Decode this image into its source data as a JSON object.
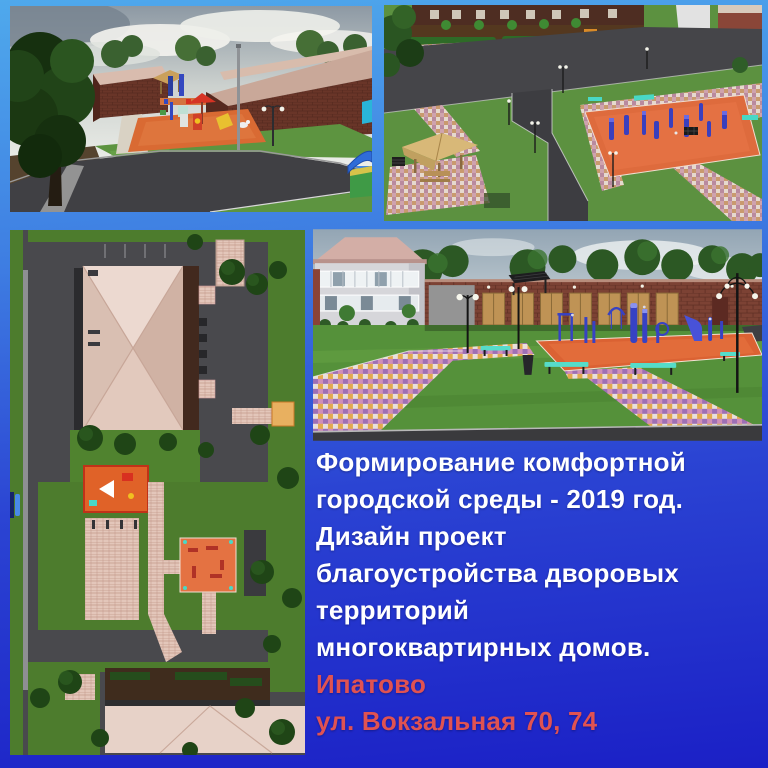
{
  "background": {
    "gradient_top": "#4fa9ec",
    "gradient_middle": "#2b44d3",
    "gradient_bottom": "#1b20c6"
  },
  "text_block": {
    "white_lines": [
      "Формирование комфортной",
      "городской среды - 2019 год.",
      "Дизайн проект",
      "благоустройства дворовых",
      "территорий",
      "многоквартирных домов."
    ],
    "red_lines": [
      "Ипатово",
      "ул. Вокзальная 70, 74"
    ],
    "white_color": "#ffffff",
    "red_color": "#e05252"
  },
  "palette": {
    "playground_orange": "#d96a33",
    "fitness_pad_orange": "#de6b3d",
    "equipment_blue": "#3a3fbe",
    "lawn_green": "#5c9140",
    "mosaic_pink": "#cf9fae",
    "bench_teal": "#49d8c6",
    "brick_red": "#7b4133",
    "roof_pink": "#e5cfc5",
    "asphalt_gray": "#454549"
  }
}
